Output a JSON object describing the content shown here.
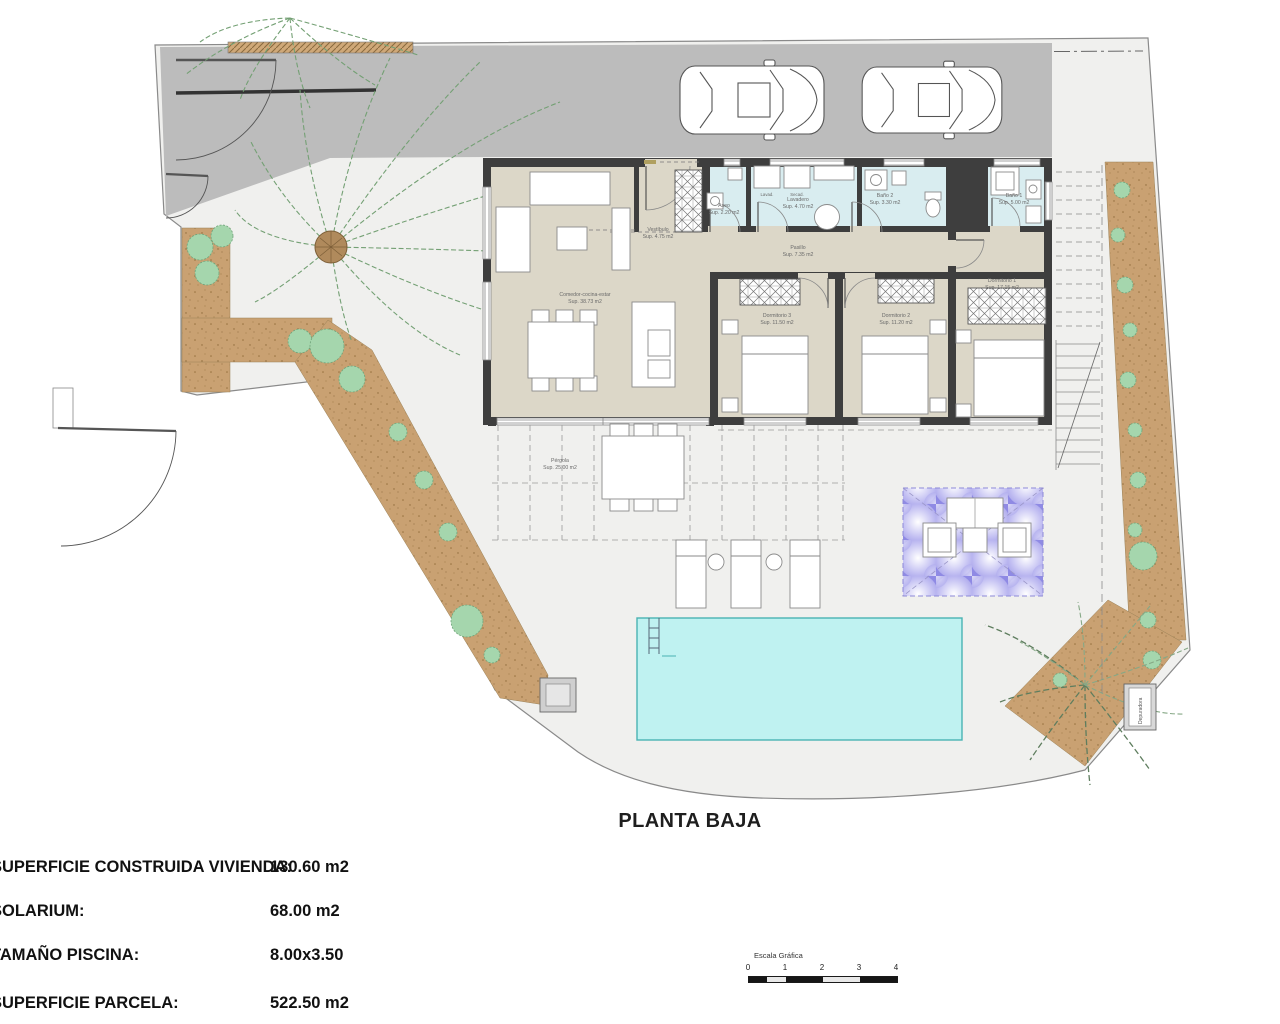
{
  "title": "PLANTA BAJA",
  "stats": [
    {
      "label": "SUPERFICIE CONSTRUIDA VIVIENDA:",
      "value": "130.60 m2"
    },
    {
      "label": "SOLARIUM:",
      "value": "68.00 m2"
    },
    {
      "label": "TAMAÑO PISCINA:",
      "value": "8.00x3.50"
    },
    {
      "label": "SUPERFICIE PARCELA:",
      "value": "522.50 m2"
    }
  ],
  "scale_bar": {
    "label": "Escala Gráfica",
    "ticks": [
      "0",
      "1",
      "2",
      "3",
      "4"
    ]
  },
  "rooms": {
    "living": {
      "name": "Comedor-cocina-estar",
      "area": "Sup. 38.73 m2"
    },
    "vestibulo": {
      "name": "Vestíbulo",
      "area": "Sup. 4.75 m2"
    },
    "aseo": {
      "name": "Aseo",
      "area": "Sup. 2.20 m2"
    },
    "lavadero": {
      "name": "Lavadero",
      "area": "Sup. 4.70 m2"
    },
    "bano2": {
      "name": "Baño 2",
      "area": "Sup. 3.30 m2"
    },
    "bano1": {
      "name": "Baño 1",
      "area": "Sup. 5.00 m2"
    },
    "pasillo": {
      "name": "Pasillo",
      "area": "Sup. 7.35 m2"
    },
    "dormitorio3": {
      "name": "Dormitorio 3",
      "area": "Sup. 11.50 m2"
    },
    "dormitorio2": {
      "name": "Dormitorio 2",
      "area": "Sup. 11.20 m2"
    },
    "dormitorio1": {
      "name": "Dormitorio 1",
      "area": "Sup. 17.15 m2"
    },
    "pergola": {
      "name": "Pérgola",
      "area": "Sup. 25.00 m2"
    }
  },
  "appliances": {
    "washer": "Lavad.",
    "dryer": "Secad."
  },
  "equipment_label": "Depuradora",
  "colors": {
    "driveway": "#bcbcbc",
    "room_floor": "#dcd7c8",
    "wet_floor": "#d9edf0",
    "wall": "#3e3e3e",
    "pool": "#bff2f1",
    "soil": "#c9a172",
    "pergola_purple": "#8f8ae4"
  }
}
